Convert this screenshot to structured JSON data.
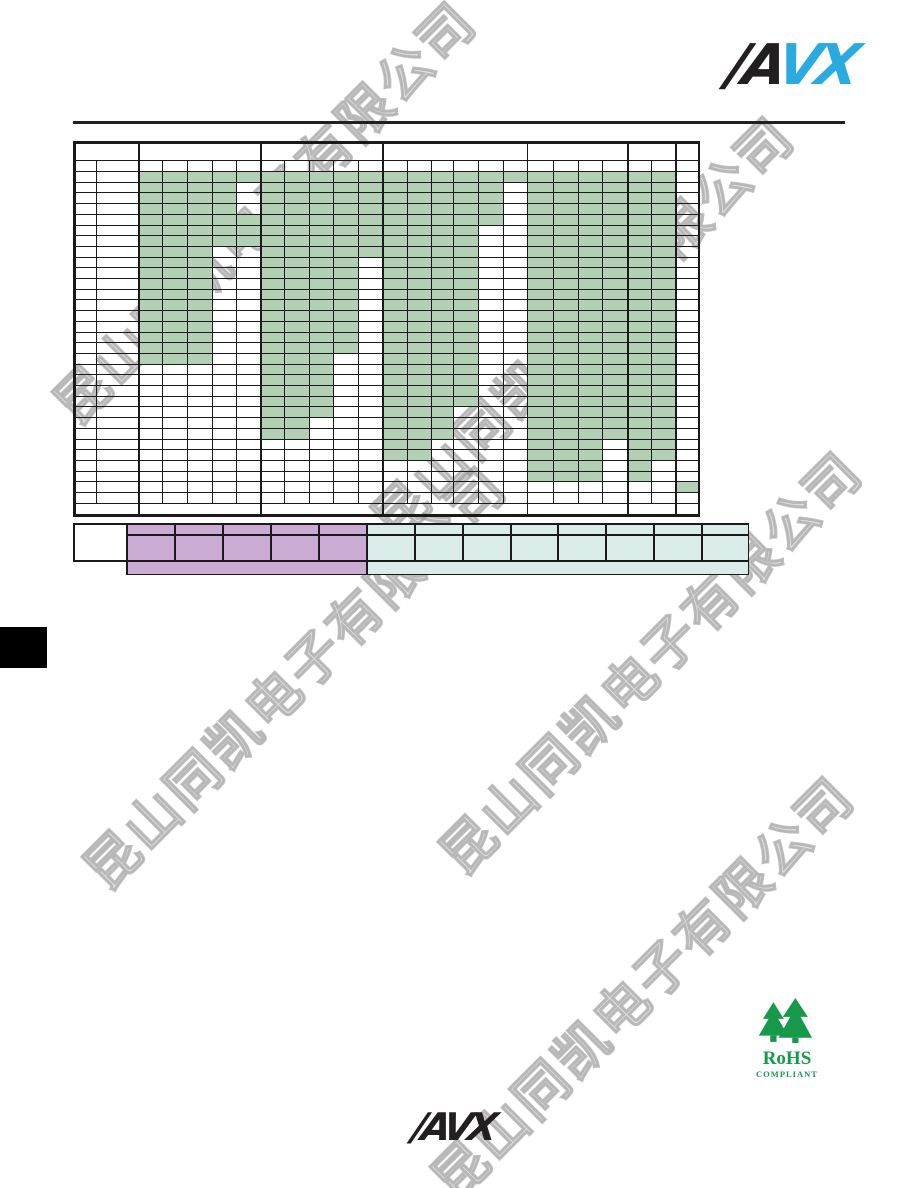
{
  "colors": {
    "page-bg": "#ffffff",
    "avx-black": "#231f20",
    "avx-cyan": "#29abe2",
    "table-line": "#1a1a1a",
    "cell-green": "#b3cfb4",
    "legend-purple": "#cbaad3",
    "legend-teal": "#d9ece9",
    "rohs-green": "#169a4a",
    "watermark-gray": "#b9b9b9",
    "tab-black": "#000000"
  },
  "watermark": {
    "text": "昆山同凯电子有限公司",
    "instances": [
      {
        "x": 262,
        "y": 210,
        "size": 54
      },
      {
        "x": 580,
        "y": 325,
        "size": 54
      },
      {
        "x": 292,
        "y": 675,
        "size": 54
      },
      {
        "x": 648,
        "y": 660,
        "size": 54
      },
      {
        "x": 640,
        "y": 985,
        "size": 54
      }
    ]
  },
  "header_logo": {
    "part_black": "/A",
    "part_cyan": "VX"
  },
  "footer_logo": {
    "part_black": "/A",
    "part_cyan": "VX"
  },
  "rohs": {
    "title": "RoHS",
    "subtitle": "COMPLIANT"
  },
  "main_table": {
    "x": 73,
    "y": 141,
    "w": 627,
    "h": 376,
    "col_edges": [
      0,
      23,
      65,
      89,
      114,
      139,
      163,
      187,
      211,
      236,
      260,
      285,
      309,
      334,
      358,
      380,
      405,
      430,
      454,
      480,
      505,
      529,
      554,
      578,
      602,
      627
    ],
    "header_heights": [
      19,
      11
    ],
    "data_rows": 31,
    "data_row_h": 10.7,
    "footer_h": 14,
    "group_col_counts": [
      5,
      5,
      6,
      4,
      2,
      1
    ],
    "v_full": [
      {
        "x": 0,
        "w": 2.5
      },
      {
        "x": 65,
        "w": 2
      },
      {
        "x": 187,
        "w": 2
      },
      {
        "x": 309,
        "w": 2
      },
      {
        "x": 454,
        "w": 1.2
      },
      {
        "x": 554,
        "w": 2
      },
      {
        "x": 602,
        "w": 2
      },
      {
        "x": 624.5,
        "w": 2.5
      }
    ],
    "v_body": [
      23,
      89,
      114,
      139,
      163,
      211,
      236,
      260,
      285,
      334,
      358,
      380,
      405,
      430,
      480,
      505,
      529,
      578
    ],
    "availability_grid": [
      "11111111111111111111110",
      "11110111111111101111110",
      "11110111111111101111110",
      "11110111111111101111110",
      "11111111111111101111110",
      "11111111111111001111110",
      "11111111111111001111110",
      "11100111111111001111110",
      "11100111101111001111110",
      "11100111101111001111110",
      "11100111101111001111110",
      "11100111101111001111110",
      "11100111101111001111110",
      "11100111101111001111110",
      "11100111101111001111110",
      "11100111101111001111110",
      "11100111101111001111110",
      "11100111001111001111110",
      "00000111001111001111110",
      "00000111001111001111110",
      "00000111001111001111110",
      "00000111001111001111110",
      "00000111001110001111110",
      "00000110001110001111110",
      "00000110001110001111110",
      "00000000001100001110110",
      "00000000001100001110110",
      "00000000000000001110100",
      "00000000000000001110100",
      "00000000000000000000001",
      "00000000000000000000000"
    ]
  },
  "legend_table": {
    "x": 73,
    "y": 523,
    "w": 676,
    "h": 52,
    "col_edges": [
      0,
      53,
      101,
      149,
      197,
      245,
      293,
      341,
      389,
      437,
      484,
      532,
      580,
      628,
      676
    ],
    "row_edges": [
      0,
      11,
      37,
      52
    ],
    "fills": [
      {
        "x0": 0,
        "y0": 0,
        "x1": 53,
        "y1": 37,
        "color": "#ffffff",
        "name": "legend-blank-cell"
      },
      {
        "x0": 53,
        "y0": 0,
        "x1": 293,
        "y1": 52,
        "color": "#cbaad3",
        "name": "legend-purple-band"
      },
      {
        "x0": 293,
        "y0": 0,
        "x1": 676,
        "y1": 52,
        "color": "#d9ece9",
        "name": "legend-teal-band"
      }
    ],
    "v_lines": [
      {
        "x": 0,
        "y0": 0,
        "y1": 37,
        "w": 1.5
      },
      {
        "x": 53,
        "y0": 0,
        "y1": 52,
        "w": 1.5
      },
      {
        "x": 101,
        "y0": 0,
        "y1": 37,
        "w": 1.5
      },
      {
        "x": 149,
        "y0": 0,
        "y1": 37,
        "w": 1.5
      },
      {
        "x": 197,
        "y0": 0,
        "y1": 37,
        "w": 1.5
      },
      {
        "x": 245,
        "y0": 0,
        "y1": 37,
        "w": 1.5
      },
      {
        "x": 293,
        "y0": 0,
        "y1": 52,
        "w": 1.5
      },
      {
        "x": 341,
        "y0": 0,
        "y1": 37,
        "w": 1.5
      },
      {
        "x": 389,
        "y0": 0,
        "y1": 37,
        "w": 1.5
      },
      {
        "x": 437,
        "y0": 0,
        "y1": 37,
        "w": 1.5
      },
      {
        "x": 484,
        "y0": 0,
        "y1": 37,
        "w": 1.5
      },
      {
        "x": 532,
        "y0": 0,
        "y1": 37,
        "w": 1.5
      },
      {
        "x": 580,
        "y0": 0,
        "y1": 37,
        "w": 1.5
      },
      {
        "x": 628,
        "y0": 0,
        "y1": 37,
        "w": 1.5
      },
      {
        "x": 674.5,
        "y0": 0,
        "y1": 52,
        "w": 1.5
      }
    ],
    "h_lines": [
      {
        "y": 0,
        "x0": 0,
        "x1": 676,
        "h": 1.5
      },
      {
        "y": 11,
        "x0": 53,
        "x1": 676,
        "h": 1.5
      },
      {
        "y": 37,
        "x0": 0,
        "x1": 676,
        "h": 1.5
      },
      {
        "y": 50.5,
        "x0": 53,
        "x1": 676,
        "h": 1.5
      }
    ]
  }
}
